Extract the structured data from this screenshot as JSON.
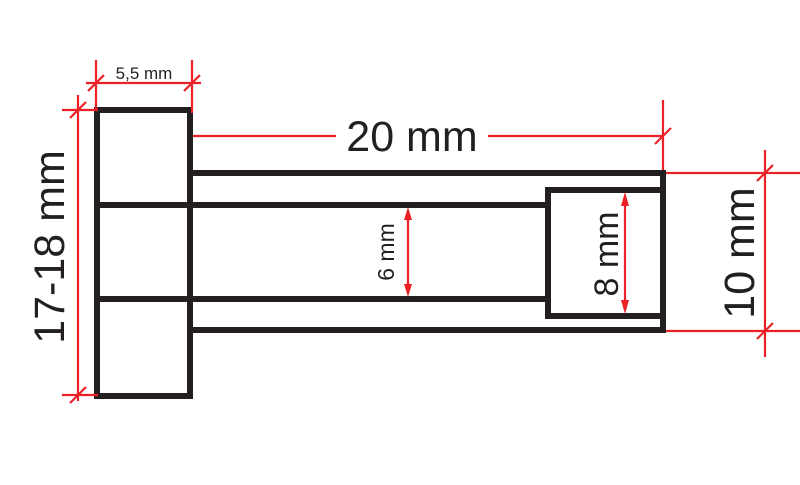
{
  "drawing": {
    "background": "#ffffff",
    "outline_color": "#231f20",
    "dimension_color": "#ec2127",
    "labels": {
      "head_width": "5,5 mm",
      "head_height": "17-18 mm",
      "shaft_length": "20 mm",
      "bore_diameter": "6 mm",
      "counterbore_diameter": "8 mm",
      "outer_diameter": "10 mm"
    }
  }
}
